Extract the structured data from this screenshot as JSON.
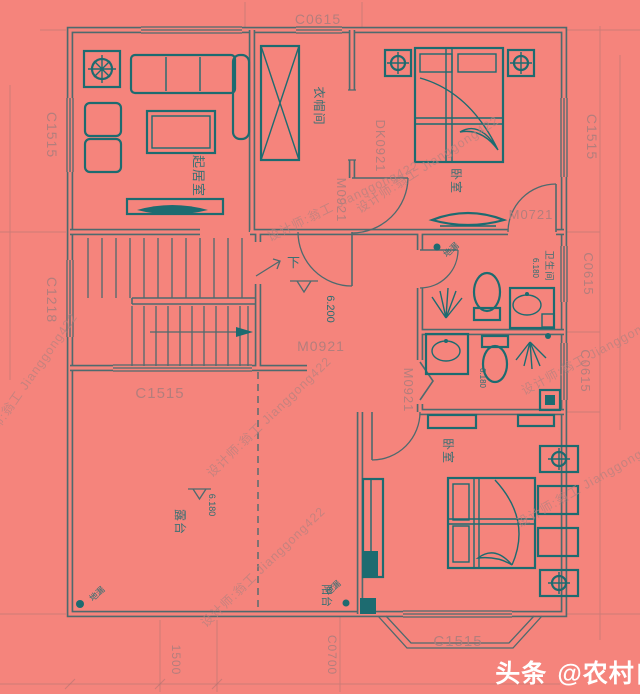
{
  "rooms": {
    "living_room": "起居室",
    "cloakroom": "衣帽间",
    "bedroom_top": "卧室",
    "bathroom": "卫生间",
    "terrace": "露台",
    "balcony": "阳台",
    "bedroom_bottom": "卧室",
    "stairs_down": "下"
  },
  "windows": {
    "top_center": "C0615",
    "left_upper": "C1515",
    "left_lower": "C1218",
    "right_upper": "C1515",
    "right_mid_upper": "C0615",
    "right_mid_lower": "C0615",
    "stair_landing": "C1515",
    "bay_bottom": "C1515",
    "balcony_bottom": "C0700"
  },
  "doors": {
    "suite_entry": "M0921",
    "cloak_to_bedroom": "M0921",
    "bedroom_bottom_door": "M0921",
    "bedroom_top_door": "M0721",
    "cased_opening": "DK0921"
  },
  "elevations": {
    "hall": "6.200",
    "bathroom_upper": "6.180",
    "bathroom_lower": "6.180",
    "terrace": "6.180"
  },
  "dimensions": {
    "bottom_left": "1500"
  },
  "annotations": {
    "floor_drain": "地漏"
  },
  "watermarks": {
    "designer": "设计师:翁工  Jianggong422"
  },
  "footer": {
    "badge": "头条",
    "handle": "@农村自建房图纸"
  },
  "colors": {
    "background": "#f5847c",
    "wall": "#4e6a6e",
    "furniture": "#1d6b70",
    "tag_text": "#b07e7c",
    "room_text": "#397073",
    "watermark": "#b5827f",
    "footer_text": "#ffffff"
  }
}
